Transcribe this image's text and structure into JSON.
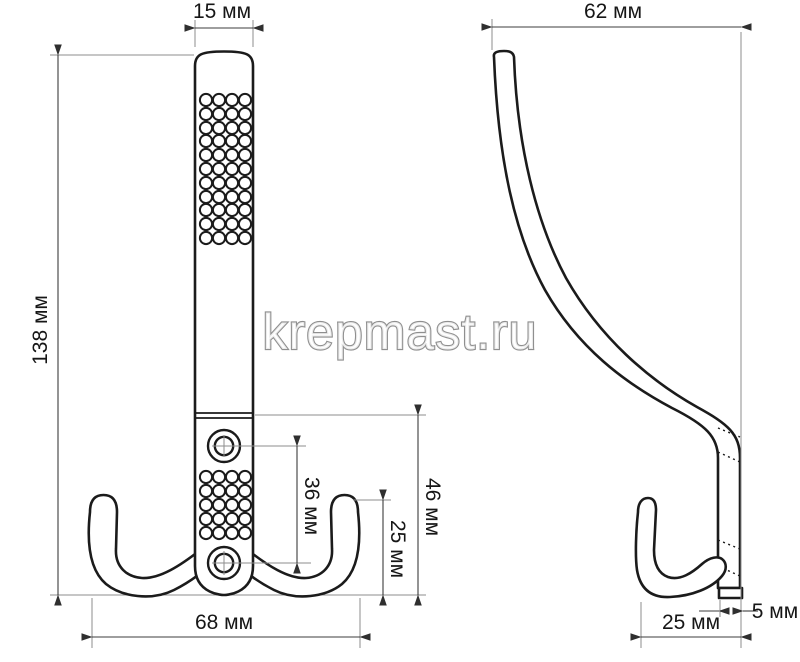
{
  "watermark": "krepmast.ru",
  "dimensions": {
    "front": {
      "top_width": "15 мм",
      "overall_height": "138 мм",
      "hole_spacing": "36 мм",
      "hook_height": "25 мм",
      "base_section_height": "46 мм",
      "overall_width": "68 мм"
    },
    "side": {
      "overall_depth": "62 мм",
      "hook_depth": "25 мм",
      "plate_thickness": "5 мм"
    }
  },
  "colors": {
    "background": "#ffffff",
    "outline": "#1b1b1b",
    "dimension_line": "#3c3c3c",
    "extension_line": "#8d8d8d",
    "watermark_outline": "#8f8f8f",
    "label_text": "#161616"
  }
}
